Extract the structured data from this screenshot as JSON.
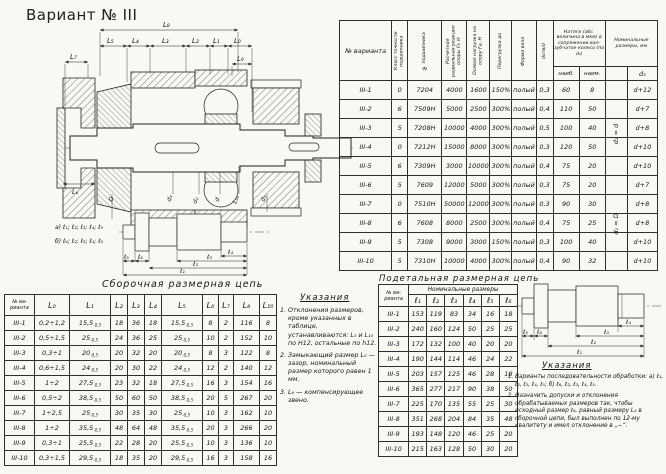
{
  "page": {
    "title": "Вариант № III"
  },
  "main_table": {
    "headers": [
      "№ варианта",
      "Класс точности подшипника",
      "№ подшипника",
      "Расчетная радиальная реакция опоры Fr, Н",
      "Осевая нагрузка на опору Fa, Н",
      "Перегрузка до",
      "Форма вала",
      "dотв/d",
      "Натяги (абс. величина в мкм) в сопряжении вал-зубчатое колесо (по d₃)",
      "Номинальные размеры, мм"
    ],
    "subheaders": [
      "наиб.",
      "наим.",
      " ",
      "d₃"
    ],
    "note_rows_1_5": "d₂ = d",
    "note_rows_6_10": "d₁ = D",
    "rows": [
      [
        "III-1",
        "0",
        "7204",
        "4000",
        "1600",
        "150%",
        "полый",
        "0,3",
        "60",
        "8",
        "",
        "d+12"
      ],
      [
        "III-2",
        "6",
        "7509Н",
        "5000",
        "2500",
        "300%",
        "полый",
        "0,4",
        "110",
        "50",
        "",
        "d+7"
      ],
      [
        "III-3",
        "5",
        "7208Н",
        "10000",
        "4000",
        "300%",
        "полый",
        "0,5",
        "100",
        "40",
        "",
        "d+8"
      ],
      [
        "III-4",
        "0",
        "7212Н",
        "15000",
        "8000",
        "300%",
        "полый",
        "0,3",
        "120",
        "50",
        "",
        "d+10"
      ],
      [
        "III-5",
        "6",
        "7309Н",
        "3000",
        "10000",
        "300%",
        "полый",
        "0,4",
        "75",
        "20",
        "",
        "d+10"
      ],
      [
        "III-6",
        "5",
        "7609",
        "12000",
        "5000",
        "300%",
        "полый",
        "0,3",
        "75",
        "20",
        "",
        "d+7"
      ],
      [
        "III-7",
        "0",
        "7510Н",
        "50000",
        "12000",
        "300%",
        "полый",
        "0,3",
        "90",
        "30",
        "",
        "d+8"
      ],
      [
        "III-8",
        "6",
        "7608",
        "8000",
        "2500",
        "300%",
        "полый",
        "0,4",
        "75",
        "25",
        "",
        "d+8"
      ],
      [
        "III-9",
        "5",
        "7308",
        "9000",
        "3000",
        "150%",
        "полый",
        "0,3",
        "100",
        "40",
        "",
        "d+10"
      ],
      [
        "III-10",
        "5",
        "7310Н",
        "10000",
        "4000",
        "300%",
        "полый",
        "0,4",
        "90",
        "32",
        "",
        "d+10"
      ]
    ]
  },
  "assembly_table": {
    "title": "Сборочная размерная цепь",
    "headers": [
      "№ ва-рианта",
      "L₀",
      "L₁",
      "L₂",
      "L₃",
      "L₄",
      "L₅",
      "L₆",
      "L₇",
      "L₈",
      "L₁₀"
    ],
    "rows": [
      [
        "III-1",
        "0,2÷1,2",
        "15,5~-0,5",
        "18",
        "36",
        "18",
        "15,5~-0,5",
        "8",
        "2",
        "116",
        "8"
      ],
      [
        "III-2",
        "0,5÷1,5",
        "25~-0,5",
        "24",
        "36",
        "25",
        "25~-0,5",
        "10",
        "2",
        "152",
        "10"
      ],
      [
        "III-3",
        "0,3÷1",
        "20~-0,5",
        "20",
        "32",
        "20",
        "20~-0,5",
        "8",
        "3",
        "122",
        "8"
      ],
      [
        "III-4",
        "0,6÷1,5",
        "24~-0,5",
        "20",
        "30",
        "22",
        "24~-0,5",
        "12",
        "2",
        "140",
        "12"
      ],
      [
        "III-5",
        "1÷2",
        "27,5~-0,5",
        "23",
        "32",
        "18",
        "27,5~-0,5",
        "16",
        "3",
        "154",
        "16"
      ],
      [
        "III-6",
        "0,5÷2",
        "38,5~-0,5",
        "50",
        "60",
        "50",
        "38,5~-0,5",
        "20",
        "5",
        "267",
        "20"
      ],
      [
        "III-7",
        "1÷2,5",
        "25~-0,5",
        "30",
        "35",
        "30",
        "25~-0,5",
        "10",
        "3",
        "162",
        "10"
      ],
      [
        "III-8",
        "1÷2",
        "35,5~-0,5",
        "48",
        "64",
        "48",
        "35,5~-0,5",
        "20",
        "3",
        "266",
        "20"
      ],
      [
        "III-9",
        "0,3÷1",
        "25,5~-0,5",
        "22",
        "28",
        "20",
        "25,5~-0,5",
        "10",
        "3",
        "136",
        "10"
      ],
      [
        "III-10",
        "0,3÷1,5",
        "29,5~-0,5",
        "18",
        "35",
        "20",
        "29,5~-0,5",
        "16",
        "3",
        "158",
        "16"
      ]
    ]
  },
  "detail_table": {
    "title": "Подетальная размерная цепь",
    "corner_header": "№ ва-рианта",
    "group_header": "Номинальные размеры",
    "subheaders": [
      "ℓ₁",
      "ℓ₂",
      "ℓ₃",
      "ℓ₄",
      "ℓ₅",
      "ℓ₆"
    ],
    "rows": [
      [
        "III-1",
        "153",
        "119",
        "83",
        "34",
        "16",
        "18"
      ],
      [
        "III-2",
        "240",
        "160",
        "124",
        "50",
        "25",
        "25"
      ],
      [
        "III-3",
        "172",
        "132",
        "100",
        "40",
        "20",
        "20"
      ],
      [
        "III-4",
        "190",
        "144",
        "114",
        "46",
        "24",
        "22"
      ],
      [
        "III-5",
        "203",
        "157",
        "125",
        "46",
        "28",
        "18"
      ],
      [
        "III-6",
        "365",
        "277",
        "217",
        "90",
        "38",
        "50"
      ],
      [
        "III-7",
        "225",
        "170",
        "135",
        "55",
        "25",
        "30"
      ],
      [
        "III-8",
        "351",
        "268",
        "204",
        "84",
        "35",
        "48"
      ],
      [
        "III-9",
        "193",
        "148",
        "120",
        "46",
        "25",
        "20"
      ],
      [
        "III-10",
        "215",
        "163",
        "128",
        "50",
        "30",
        "20"
      ]
    ]
  },
  "notes_left": {
    "title": "Указания",
    "items": [
      "Отклонения размеров, кроме указанных в таблице, устанавливаются: L₀ и L₁₀ по Н12, остальные по h12.",
      "Замыкающий размер L₀ — зазор, номинальный размер которого равен 1 мм.",
      "L₉ — компенсирующее звено."
    ]
  },
  "notes_right": {
    "title": "Указания",
    "items": [
      "Варианты последовательности обработки: а) ℓ₁, ℓ₂, ℓ₃, ℓ₄, ℓ₅; б) ℓ₆, ℓ₂, ℓ₃, ℓ₄, ℓ₅.",
      "Назначить допуски и отклонения обрабатываемых размеров так, чтобы исходный размер ℓ₆, равный размеру L₄ в сборочной цепи, был выполнен по 12-му квалитету и имел отклонение в „−“."
    ]
  },
  "drawing": {
    "dims_top": {
      "l7": "L₇",
      "l8": "L₈",
      "l5": "L₅",
      "l4": "L₄",
      "l3": "L₃",
      "l2": "L₂",
      "l1": "L₁",
      "l0": "L₀",
      "l9": "L₉"
    },
    "dims_bottom": [
      "L₆",
      "D",
      "d₃",
      "d₂",
      "d",
      "L₁₀",
      "d₁"
    ],
    "seq_a": "а) ℓ₁; ℓ₂; ℓ₃; ℓ₄; ℓ₅",
    "seq_b": "б) ℓ₆; ℓ₂; ℓ₃; ℓ₄; ℓ₅",
    "shaft_dims": {
      "l1": "ℓ₁",
      "l2": "ℓ₂",
      "l3": "ℓ₃",
      "l4": "ℓ₄",
      "l5": "ℓ₅",
      "l6": "ℓ₆"
    }
  }
}
